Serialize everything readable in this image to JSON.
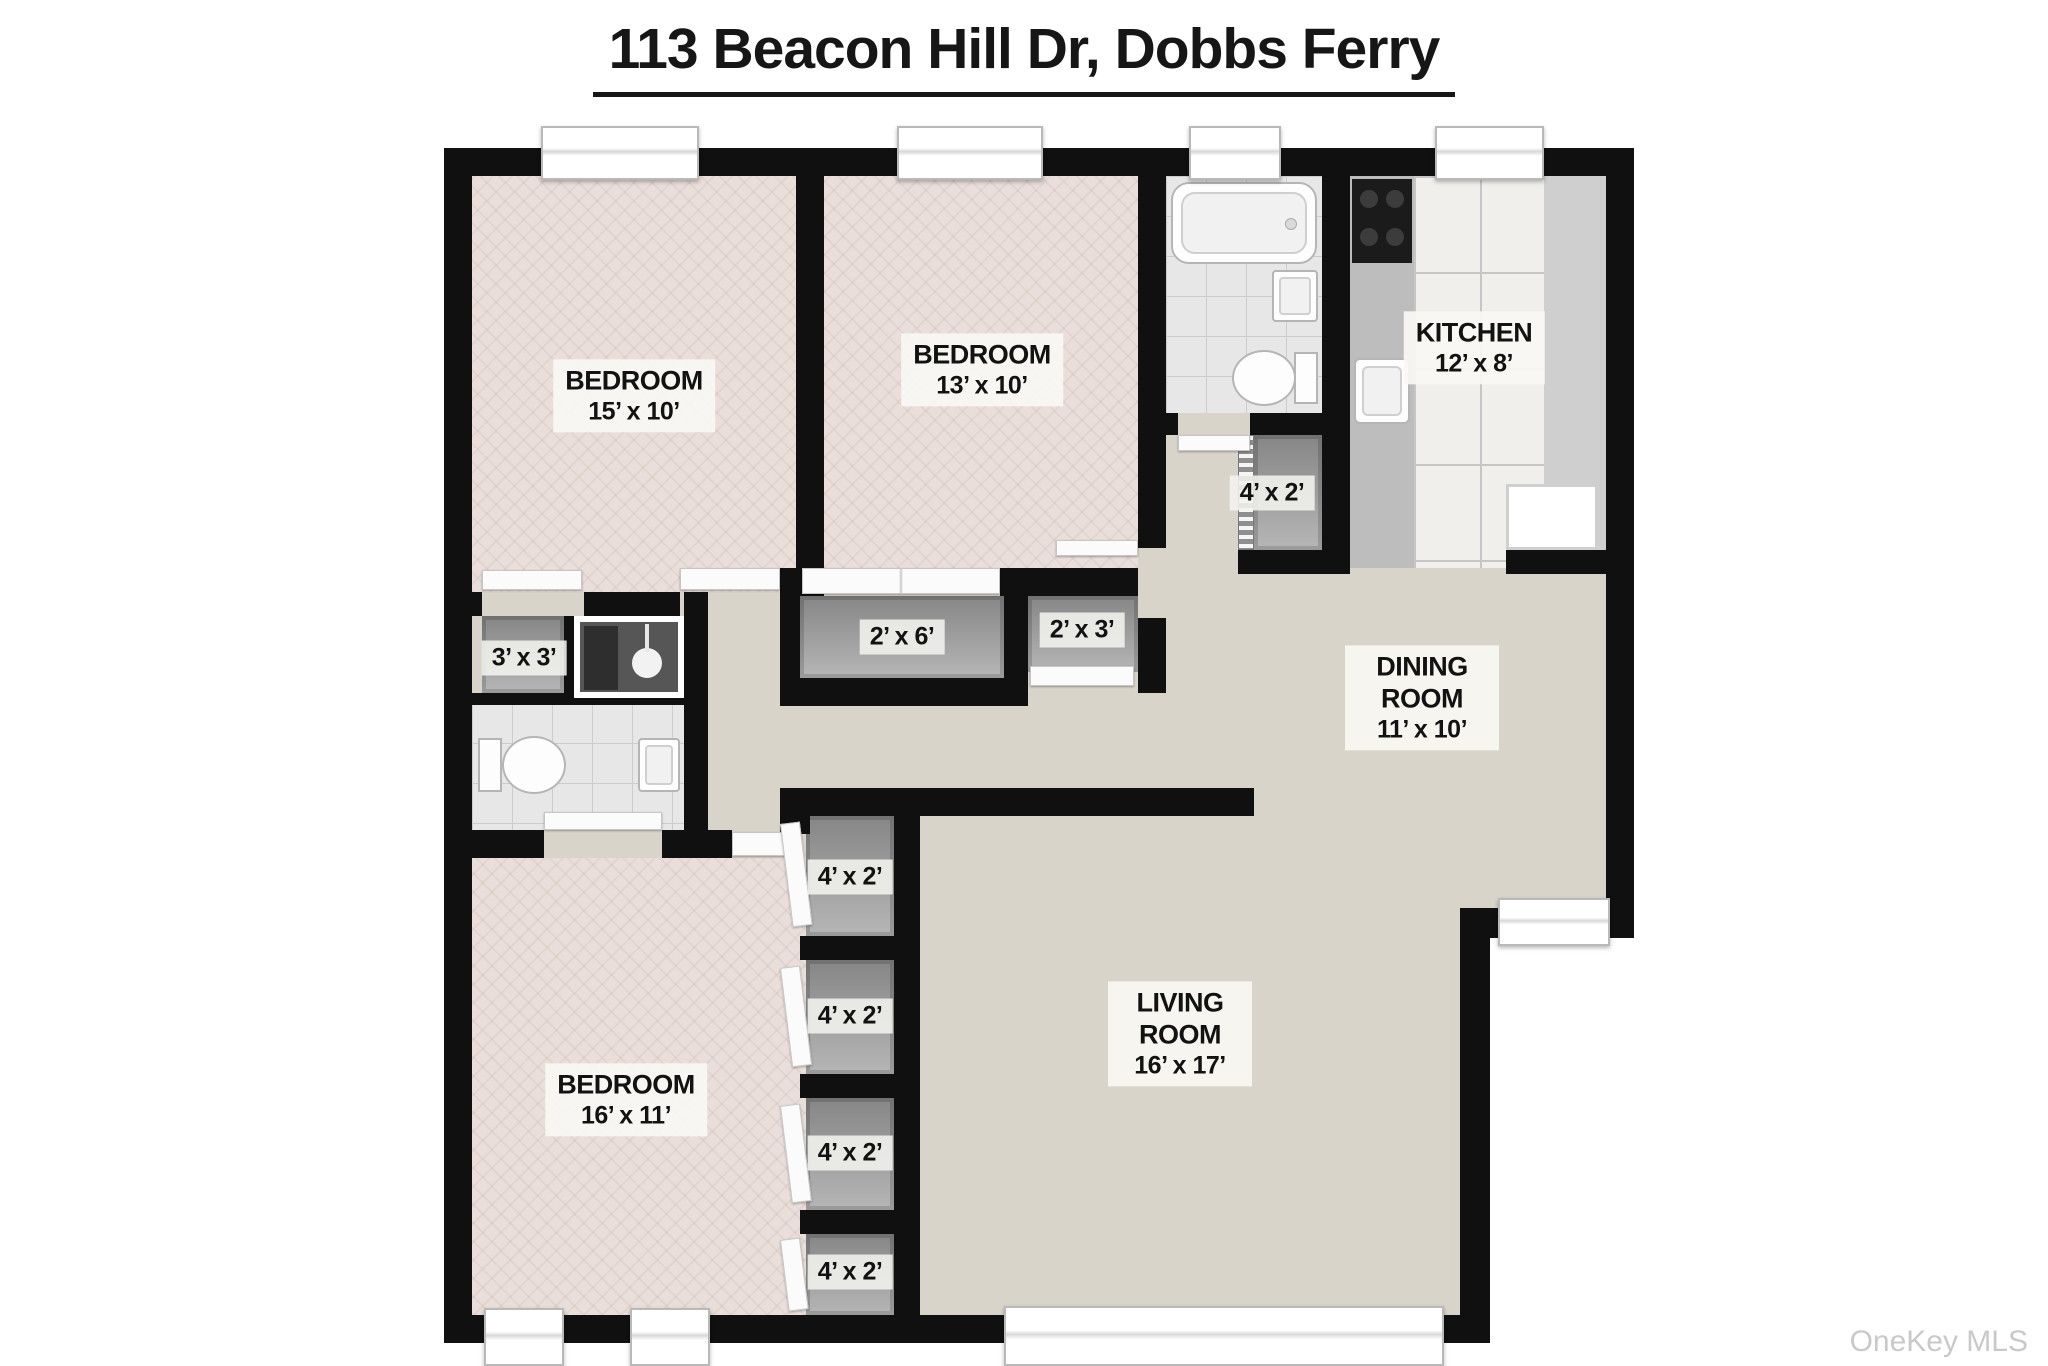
{
  "title": "113 Beacon Hill Dr, Dobbs Ferry",
  "watermark": "OneKey MLS",
  "rooms": {
    "bedroom1": {
      "name": "BEDROOM",
      "dims": "15’ x 10’"
    },
    "bedroom2": {
      "name": "BEDROOM",
      "dims": "13’ x 10’"
    },
    "kitchen": {
      "name": "KITCHEN",
      "dims": "12’ x 8’"
    },
    "dining": {
      "name": "DINING ROOM",
      "dims": "11’ x 10’"
    },
    "living": {
      "name": "LIVING ROOM",
      "dims": "16’ x 17’"
    },
    "bedroom3": {
      "name": "BEDROOM",
      "dims": "16’ x 11’"
    }
  },
  "closets": {
    "hall": {
      "dims": "4’ x 2’"
    },
    "small": {
      "dims": "3’ x 3’"
    },
    "wide": {
      "dims": "2’ x 6’"
    },
    "narrow": {
      "dims": "2’ x 3’"
    },
    "column": [
      {
        "dims": "4’ x 2’"
      },
      {
        "dims": "4’ x 2’"
      },
      {
        "dims": "4’ x 2’"
      },
      {
        "dims": "4’ x 2’"
      }
    ]
  },
  "colors": {
    "wall": "#101010",
    "carpet": "#d9d4c9",
    "bedroom_floor": "#e9deda"
  }
}
